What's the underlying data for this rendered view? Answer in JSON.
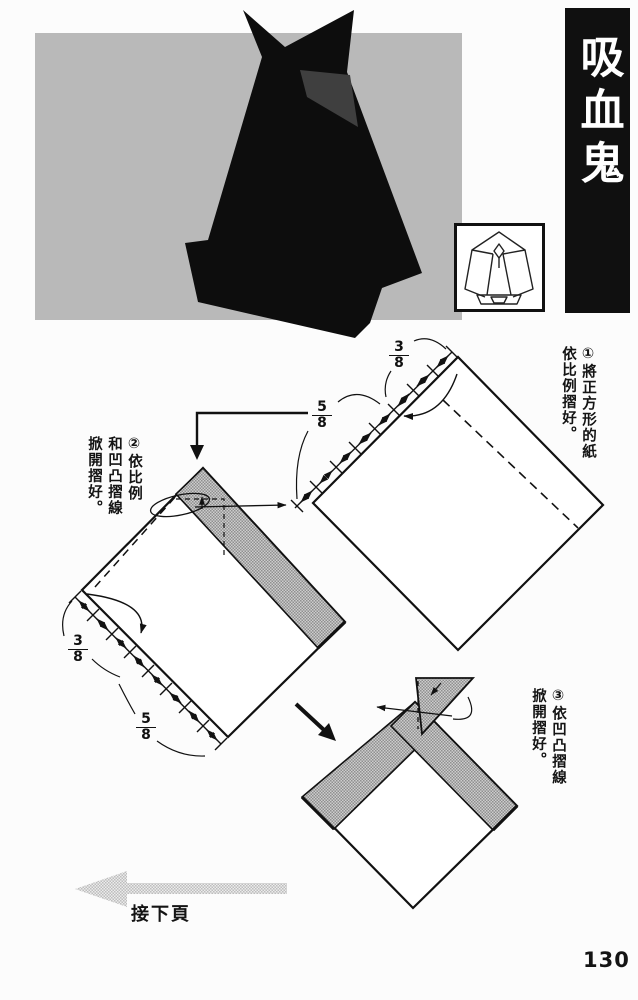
{
  "header": {
    "title": "吸血鬼"
  },
  "page": {
    "number": "130"
  },
  "nav": {
    "continue_label": "接下頁"
  },
  "steps": {
    "step1": {
      "line1": "①將正方形的紙",
      "line2": "依比例摺好。"
    },
    "step2": {
      "line1": "②依比例",
      "line2": "和凹凸摺線",
      "line3": "掀開摺好。"
    },
    "step3": {
      "line1": "③依凹凸摺線",
      "line2": "掀開摺好。"
    }
  },
  "fractions": {
    "step1_top": {
      "num": "3",
      "den": "8"
    },
    "step1_bottom": {
      "num": "5",
      "den": "8"
    },
    "step2_top": {
      "num": "3",
      "den": "8"
    },
    "step2_bottom": {
      "num": "5",
      "den": "8"
    }
  },
  "colors": {
    "photo_bg": "#b9b9b9",
    "title_bar_bg": "#101010",
    "ink": "#141414",
    "halftone_dot": "#8f8f8f"
  }
}
